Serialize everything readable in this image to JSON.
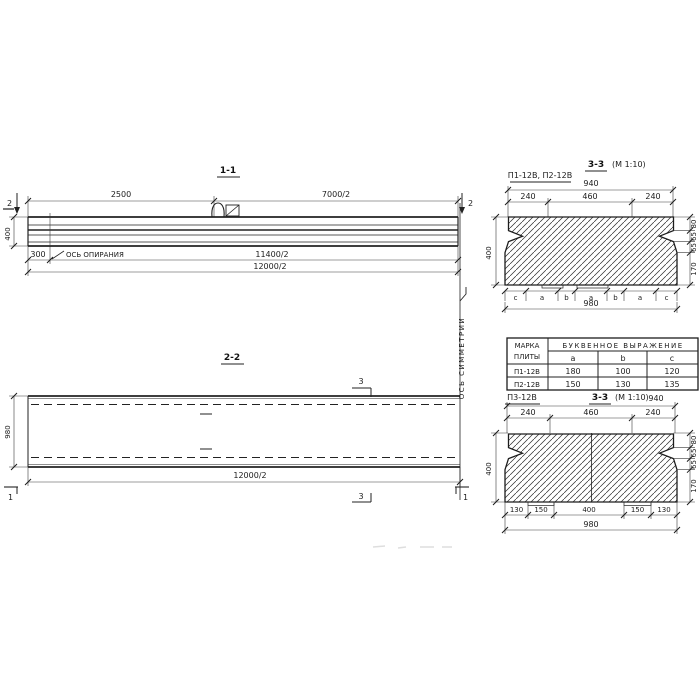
{
  "s11": {
    "title": "1-1",
    "cut_left": "2",
    "cut_right": "2",
    "dim_2500": "2500",
    "dim_7000": "7000/2",
    "dim_400": "400",
    "dim_300": "300",
    "bearing_axis_label": "ОСЬ ОПИРАНИЯ",
    "dim_11400": "11400/2",
    "dim_12000": "12000/2"
  },
  "s22": {
    "title": "2-2",
    "cut_3_top": "3",
    "cut_3_bottom": "3",
    "cut_1_left": "1",
    "cut_1_right": "1",
    "dim_980": "980",
    "dim_12000": "12000/2",
    "symmetry_axis_label": "ОСЬ СИММЕТРИИ"
  },
  "s33a": {
    "label": "П1-12В, П2-12В",
    "title": "3-3",
    "scale": "(М 1:10)",
    "dim_940": "940",
    "dims_top": [
      "240",
      "460",
      "240"
    ],
    "dim_400": "400",
    "dims_right": [
      "80",
      "65",
      "65",
      "170"
    ],
    "letters": [
      "c",
      "a",
      "b",
      "a",
      "b",
      "a",
      "c"
    ],
    "dim_980": "980"
  },
  "table": {
    "col_mark": [
      "МАРКА",
      "ПЛИТЫ"
    ],
    "header": "БУКВЕННОЕ ВЫРАЖЕНИЕ",
    "cols": [
      "a",
      "b",
      "c"
    ],
    "rows": [
      [
        "П1-12В",
        "180",
        "100",
        "120"
      ],
      [
        "П2-12В",
        "150",
        "130",
        "135"
      ]
    ]
  },
  "s33b": {
    "label": "П3-12В",
    "title": "3-3",
    "scale": "(М 1:10)",
    "dim_940": "940",
    "dims_top": [
      "240",
      "460",
      "240"
    ],
    "dim_400": "400",
    "dims_right": [
      "80",
      "65",
      "65",
      "170"
    ],
    "dims_bottom": [
      "130",
      "150",
      "400",
      "150",
      "130"
    ],
    "dim_980": "980"
  }
}
